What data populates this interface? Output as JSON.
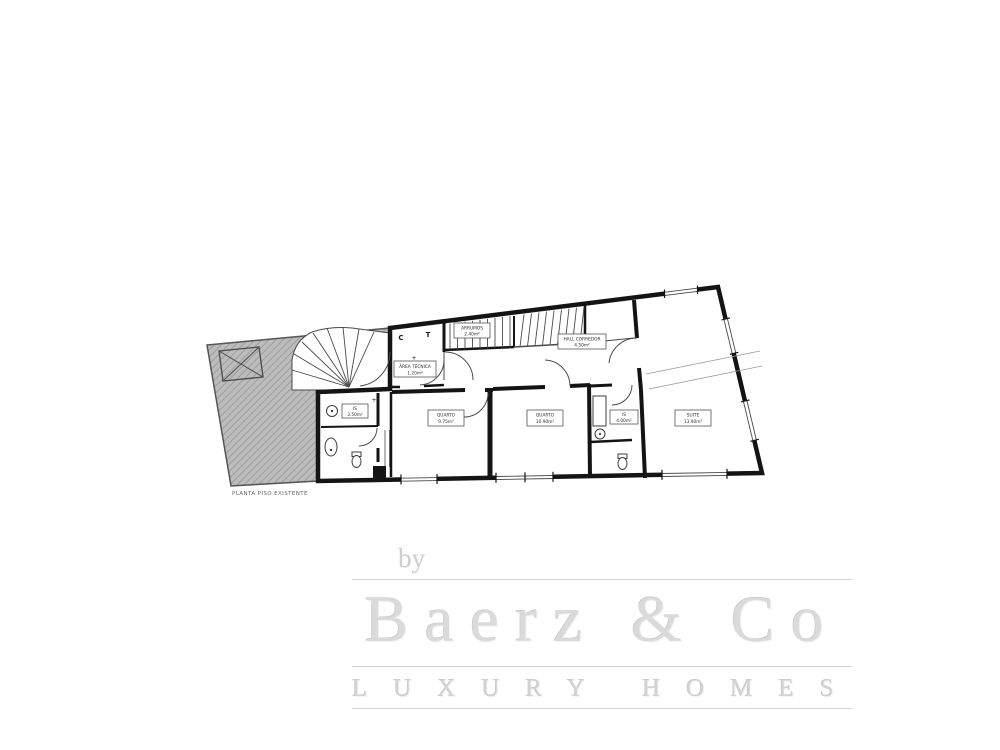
{
  "page": {
    "background": "#ffffff"
  },
  "floor_plan": {
    "caption": "PLANTA PISO EXISTENTE",
    "markers": {
      "c": "C",
      "t": "T",
      "plus": "+"
    },
    "labels": {
      "area_tecnica": {
        "line1": "ÁREA TÉCNICA",
        "line2": "1.20m²"
      },
      "arrumos": {
        "line1": "ARRUMOS",
        "line2": "2.40m²"
      },
      "hall": {
        "line1": "HALL CORREDOR",
        "line2": "4.50m²"
      },
      "is_1": {
        "line1": "IS",
        "line2": "3.50m²"
      },
      "quarto_1": {
        "line1": "QUARTO",
        "line2": "9.75m²"
      },
      "quarto_2": {
        "line1": "QUARTO",
        "line2": "10.90m²"
      },
      "is_2": {
        "line1": "IS",
        "line2": "4.00m²"
      },
      "suite": {
        "line1": "SUITE",
        "line2": "13.90m²"
      }
    },
    "colors": {
      "wall": "#141414",
      "thin_line": "#4a4a4a",
      "hatch_fill": "#bcbcbc",
      "hatch_line": "#969696",
      "label_text": "#2e2e2e"
    }
  },
  "watermark": {
    "prefix": "by",
    "brand": "Baerz & Co",
    "tagline": "LUXURY HOMES",
    "color": "#d6d6d6"
  }
}
